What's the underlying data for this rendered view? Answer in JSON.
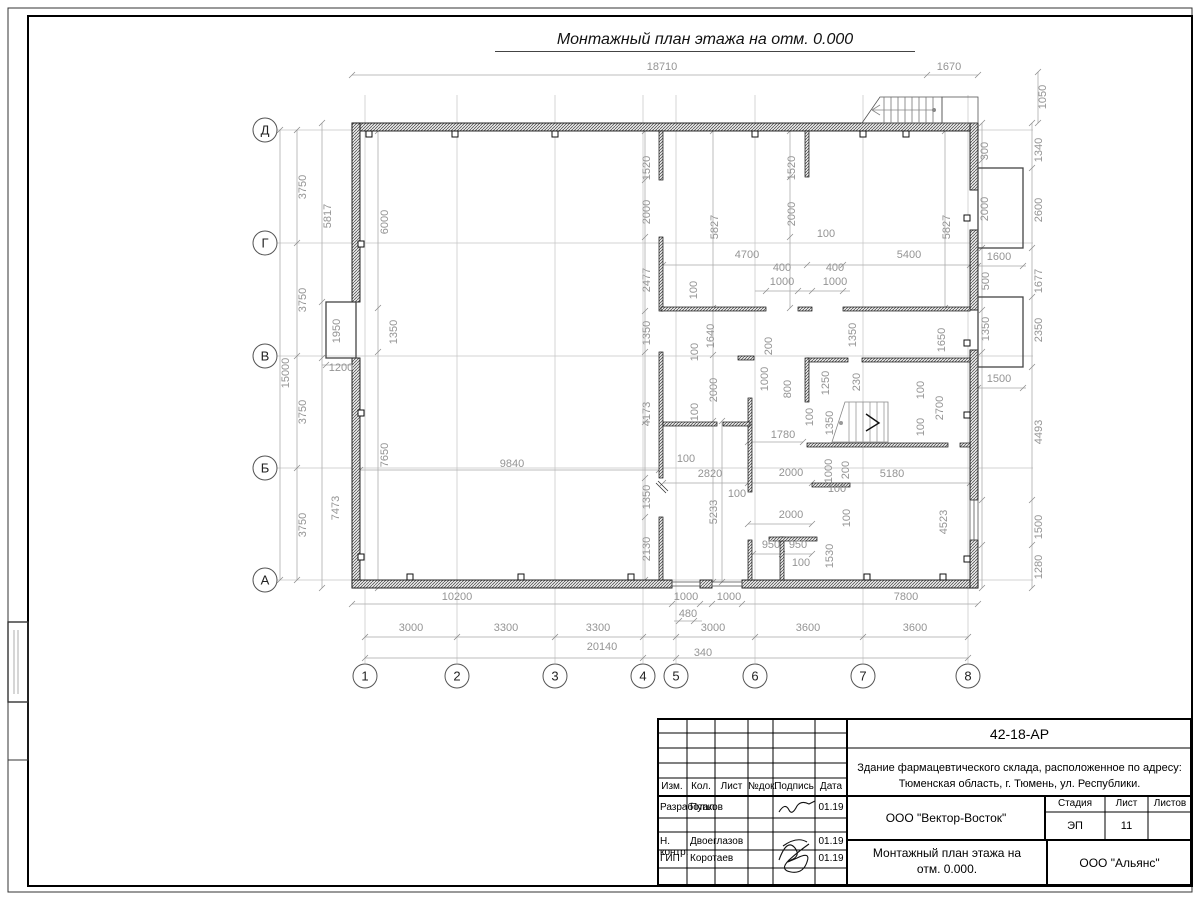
{
  "sheet": {
    "title": "Монтажный план этажа на отм. 0.000"
  },
  "axes": {
    "bubble_x": 265,
    "bubble_y": 676,
    "rows": [
      {
        "label": "Д",
        "y": 130
      },
      {
        "label": "Г",
        "y": 243
      },
      {
        "label": "В",
        "y": 356
      },
      {
        "label": "Б",
        "y": 468
      },
      {
        "label": "А",
        "y": 580
      }
    ],
    "columns": [
      {
        "label": "1",
        "x": 365
      },
      {
        "label": "2",
        "x": 457
      },
      {
        "label": "3",
        "x": 555
      },
      {
        "label": "4",
        "x": 643
      },
      {
        "label": "5",
        "x": 676
      },
      {
        "label": "6",
        "x": 755
      },
      {
        "label": "7",
        "x": 863
      },
      {
        "label": "8",
        "x": 968
      }
    ]
  },
  "dim_labels": [
    [
      "18710",
      662,
      70,
      0
    ],
    [
      "1670",
      949,
      70,
      0
    ],
    [
      "1050",
      1046,
      97,
      1
    ],
    [
      "3750",
      306,
      187,
      1
    ],
    [
      "3750",
      306,
      300,
      1
    ],
    [
      "3750",
      306,
      412,
      1
    ],
    [
      "3750",
      306,
      525,
      1
    ],
    [
      "15000",
      289,
      373,
      1
    ],
    [
      "5817",
      331,
      216,
      1
    ],
    [
      "1950",
      340,
      331,
      1
    ],
    [
      "1200",
      341,
      371,
      0
    ],
    [
      "7473",
      339,
      508,
      1
    ],
    [
      "6000",
      388,
      222,
      1
    ],
    [
      "1350",
      397,
      332,
      1
    ],
    [
      "7650",
      388,
      455,
      1
    ],
    [
      "9840",
      512,
      467,
      0
    ],
    [
      "10200",
      457,
      600,
      0
    ],
    [
      "1000",
      686,
      600,
      0
    ],
    [
      "1000",
      729,
      600,
      0
    ],
    [
      "7800",
      906,
      600,
      0
    ],
    [
      "480",
      688,
      617,
      0
    ],
    [
      "3000",
      411,
      631,
      0
    ],
    [
      "3300",
      506,
      631,
      0
    ],
    [
      "3300",
      598,
      631,
      0
    ],
    [
      "3000",
      713,
      631,
      0
    ],
    [
      "3600",
      808,
      631,
      0
    ],
    [
      "3600",
      915,
      631,
      0
    ],
    [
      "20140",
      602,
      650,
      0
    ],
    [
      "340",
      703,
      656,
      0
    ],
    [
      "300",
      988,
      151,
      1
    ],
    [
      "2000",
      988,
      209,
      1
    ],
    [
      "1600",
      999,
      260,
      0
    ],
    [
      "500",
      989,
      281,
      1
    ],
    [
      "1350",
      989,
      329,
      1
    ],
    [
      "1500",
      999,
      382,
      0
    ],
    [
      "1340",
      1042,
      150,
      1
    ],
    [
      "2600",
      1042,
      210,
      1
    ],
    [
      "1677",
      1042,
      281,
      1
    ],
    [
      "2350",
      1042,
      330,
      1
    ],
    [
      "4493",
      1042,
      432,
      1
    ],
    [
      "1500",
      1042,
      527,
      1
    ],
    [
      "1280",
      1042,
      567,
      1
    ],
    [
      "1520",
      650,
      168,
      1
    ],
    [
      "2000",
      650,
      212,
      1
    ],
    [
      "2477",
      650,
      280,
      1
    ],
    [
      "5827",
      718,
      227,
      1
    ],
    [
      "1520",
      795,
      168,
      1
    ],
    [
      "2000",
      795,
      214,
      1
    ],
    [
      "5827",
      950,
      227,
      1
    ],
    [
      "100",
      826,
      237,
      0
    ],
    [
      "4700",
      747,
      258,
      0
    ],
    [
      "5400",
      909,
      258,
      0
    ],
    [
      "400",
      782,
      271,
      0
    ],
    [
      "400",
      835,
      271,
      0
    ],
    [
      "1000",
      782,
      285,
      0
    ],
    [
      "1000",
      835,
      285,
      0
    ],
    [
      "100",
      697,
      290,
      1
    ],
    [
      "1350",
      650,
      333,
      1
    ],
    [
      "4173",
      650,
      414,
      1
    ],
    [
      "1640",
      714,
      336,
      1
    ],
    [
      "100",
      698,
      352,
      1
    ],
    [
      "2000",
      717,
      390,
      1
    ],
    [
      "100",
      698,
      412,
      1
    ],
    [
      "200",
      772,
      346,
      1
    ],
    [
      "1000",
      768,
      379,
      1
    ],
    [
      "800",
      791,
      389,
      1
    ],
    [
      "1250",
      829,
      383,
      1
    ],
    [
      "100",
      813,
      417,
      1
    ],
    [
      "1350",
      833,
      423,
      1
    ],
    [
      "230",
      860,
      382,
      1
    ],
    [
      "1350",
      856,
      335,
      1
    ],
    [
      "1650",
      945,
      340,
      1
    ],
    [
      "100",
      924,
      390,
      1
    ],
    [
      "2700",
      943,
      408,
      1
    ],
    [
      "100",
      924,
      427,
      1
    ],
    [
      "1780",
      783,
      438,
      0
    ],
    [
      "100",
      686,
      462,
      0
    ],
    [
      "2820",
      710,
      477,
      0
    ],
    [
      "5233",
      717,
      512,
      1
    ],
    [
      "100",
      737,
      497,
      0
    ],
    [
      "1350",
      650,
      497,
      1
    ],
    [
      "2130",
      650,
      549,
      1
    ],
    [
      "2000",
      791,
      476,
      0
    ],
    [
      "2000",
      791,
      518,
      0
    ],
    [
      "950",
      771,
      548,
      0
    ],
    [
      "950",
      798,
      548,
      0
    ],
    [
      "100",
      801,
      566,
      0
    ],
    [
      "1530",
      833,
      556,
      1
    ],
    [
      "1000",
      832,
      471,
      1
    ],
    [
      "200",
      849,
      470,
      1
    ],
    [
      "100",
      837,
      492,
      0
    ],
    [
      "100",
      850,
      518,
      1
    ],
    [
      "5180",
      892,
      477,
      0
    ],
    [
      "4523",
      947,
      522,
      1
    ]
  ],
  "title_block": {
    "doc_number": "42-18-АР",
    "project_line1": "Здание фармацевтического склада, расположенное по адресу:",
    "project_line2": "Тюменская область, г. Тюмень, ул. Республики.",
    "header_cells": [
      "Изм.",
      "Кол.",
      "Лист",
      "№док.",
      "Подпись",
      "Дата"
    ],
    "stage_label": "Стадия",
    "sheet_label": "Лист",
    "sheets_label": "Листов",
    "stage": "ЭП",
    "sheet_no": "11",
    "sheets_total": "",
    "rows": [
      {
        "role": "Разработал",
        "name": "Пупков",
        "date": "01.19"
      },
      {
        "role": "Н. контр.",
        "name": "Двоеглазов",
        "date": "01.19"
      },
      {
        "role": "ГИП",
        "name": "Коротаев",
        "date": "01.19"
      }
    ],
    "company": "ООО \"Вектор-Восток\"",
    "drawing_name_line1": "Монтажный план этажа на",
    "drawing_name_line2": "отм. 0.000.",
    "org": "ООО \"Альянс\""
  }
}
